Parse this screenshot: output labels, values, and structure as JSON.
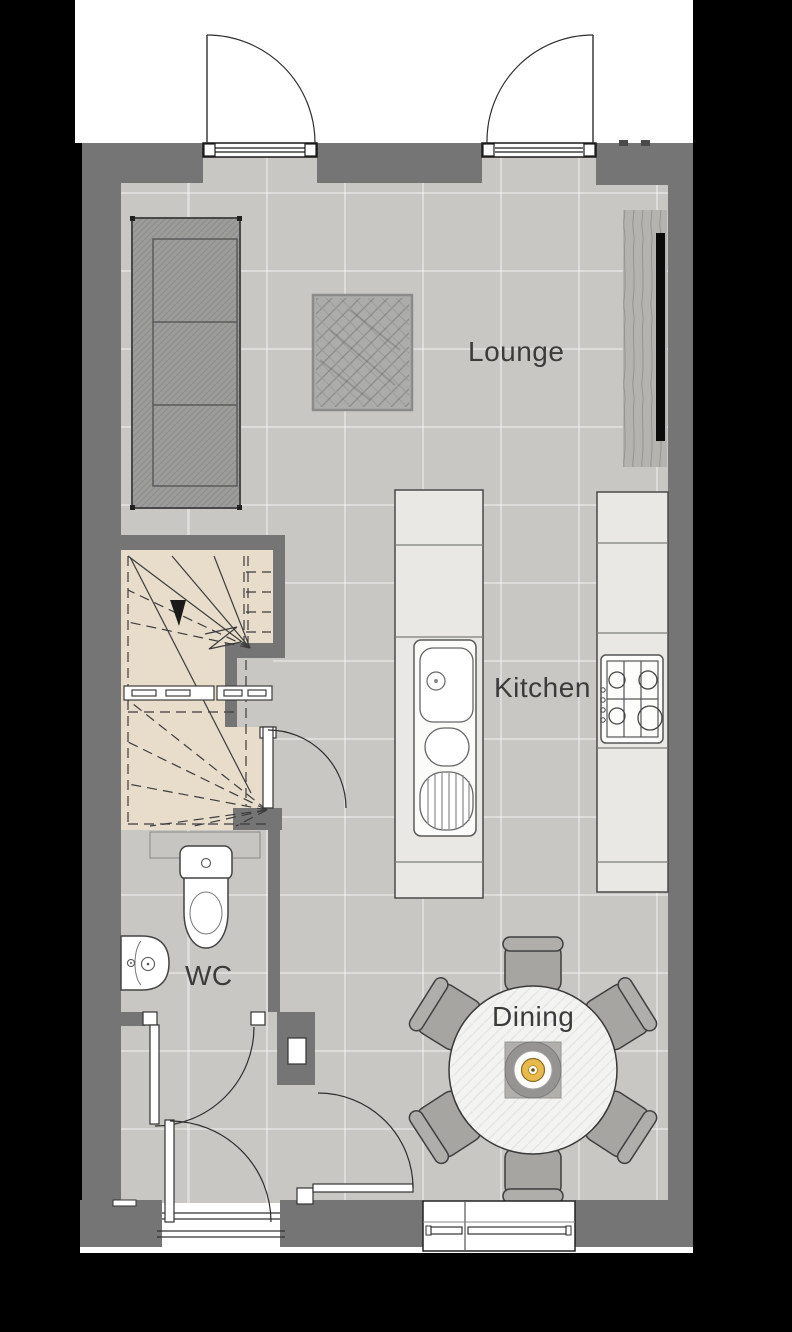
{
  "plan": {
    "title": "Ground floor plan",
    "rooms": [
      {
        "label": "Lounge",
        "features": [
          "sofa",
          "rug",
          "tv-media-unit",
          "double-doors"
        ]
      },
      {
        "label": "Kitchen",
        "features": [
          "island-with-sink",
          "counter-with-gas-hob"
        ]
      },
      {
        "label": "WC",
        "features": [
          "toilet",
          "basin"
        ]
      },
      {
        "label": "Dining",
        "features": [
          "round-table",
          "six-chairs",
          "pendant-centerpiece",
          "window"
        ]
      }
    ],
    "other_elements": [
      "winder-staircase-with-down-arrow",
      "entrance-hall",
      "front-door",
      "internal-doors"
    ],
    "colors": {
      "background": "#000000",
      "exterior": "#ffffff",
      "wall": "#757575",
      "floor_tile": "#c9c7c4",
      "stairs": "#e7ddca",
      "counter": "#e9e8e5",
      "sofa": "#9c9c9a",
      "rug": "#acacaa",
      "wood_unit": "#b5b3b0",
      "tv": "#0b0b0b",
      "pendant_amber": "#e8ba4e",
      "label_text": "#3b3b3b"
    }
  }
}
